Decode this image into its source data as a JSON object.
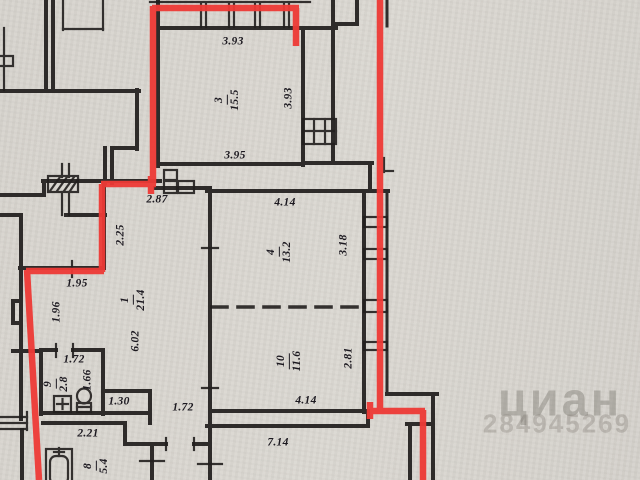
{
  "meta": {
    "description": "BTI apartment floor plan with red apartment-boundary overlay",
    "colors": {
      "paper": "#d8d4cf",
      "ink": "#221f1e",
      "outline_red": "#ee3a36",
      "watermark_gray": "#69635a"
    }
  },
  "watermark": {
    "brand": "циан",
    "listing_id": "284945269"
  },
  "rooms": [
    {
      "number": "1",
      "area": "21.4"
    },
    {
      "number": "3",
      "area": "15.5"
    },
    {
      "number": "4",
      "area": "13.2"
    },
    {
      "number": "8",
      "area": "5.4"
    },
    {
      "number": "9",
      "area": "2.8"
    },
    {
      "number": "10",
      "area": "11.6"
    }
  ],
  "dimensions": {
    "room3_top": "3.93",
    "room3_right": "3.93",
    "room3_bottom": "3.95",
    "entry_width": "2.87",
    "room4_top": "4.14",
    "room4_right": "3.18",
    "hall_upper": "2.25",
    "hall_width": "1.95",
    "hall_left": "1.96",
    "hall_length": "6.02",
    "wc_top": "1.72",
    "wc_right": "1.66",
    "corridor_a": "1.30",
    "corridor_b": "1.72",
    "room10_right": "2.81",
    "room10_bottom": "4.14",
    "outer_bottom": "7.14",
    "bath_top": "2.21"
  }
}
